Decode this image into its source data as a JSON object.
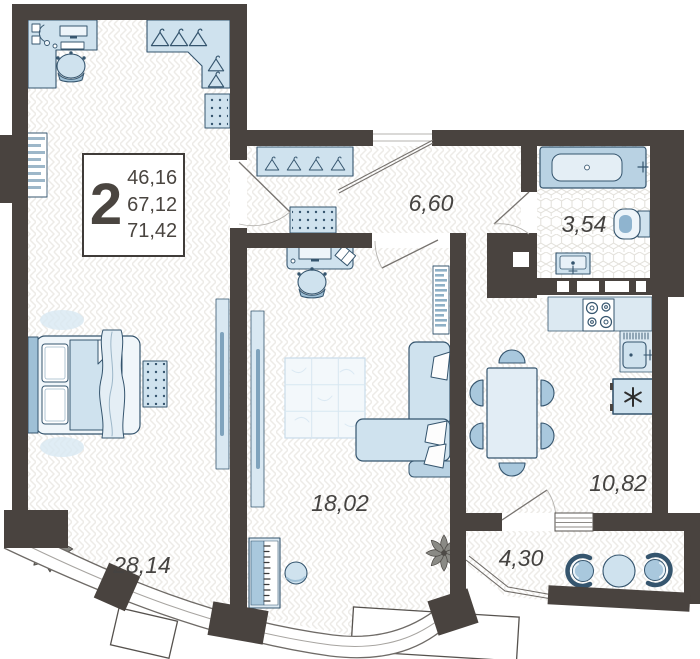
{
  "apartment": {
    "rooms_count": "2",
    "area_living": "46,16",
    "area_usable": "67,12",
    "area_total": "71,42"
  },
  "rooms": {
    "bedroom": "28,14",
    "living": "18,02",
    "hallway": "6,60",
    "bathroom": "3,54",
    "kitchen": "10,82",
    "balcony": "4,30"
  },
  "icons": {
    "fridge": "asterisk-snowflake-icon",
    "stove": "four-burner-stove-icon",
    "plant": "potted-plant-icon",
    "hanger": "clothes-hanger-icon"
  },
  "colors": {
    "wall": "#49433f",
    "furniture_fill": "#cfe2ee",
    "furniture_accent": "#a9c8dd",
    "furniture_stroke": "#35556e",
    "label_text": "#454341"
  }
}
